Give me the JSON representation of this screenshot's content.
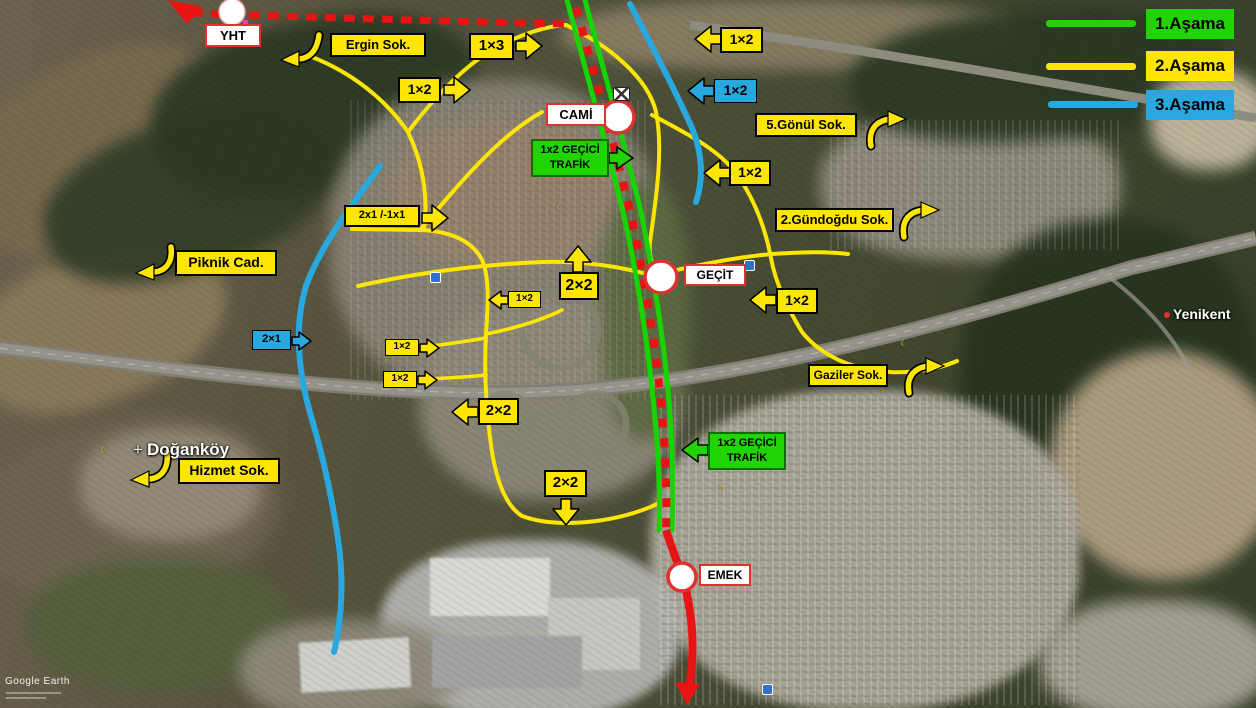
{
  "legend": {
    "items": [
      {
        "label": "1.Aşama",
        "color": "#1fd400"
      },
      {
        "label": "2.Aşama",
        "color": "#ffe600"
      },
      {
        "label": "3.Aşama",
        "color": "#29a8e0"
      }
    ]
  },
  "stations": [
    {
      "label": "YHT"
    },
    {
      "label": "CAMİ"
    },
    {
      "label": "GEÇİT"
    },
    {
      "label": "EMEK"
    }
  ],
  "map_labels": [
    {
      "text": "Ergin Sok."
    },
    {
      "text": "1×3"
    },
    {
      "text": "1×2"
    },
    {
      "text": "1×2"
    },
    {
      "text": "1×2"
    },
    {
      "text": "5.Gönül Sok."
    },
    {
      "text": "1×2"
    },
    {
      "text": "2.Gündoğdu Sok."
    },
    {
      "text": "2x1 /-1x1"
    },
    {
      "text": "Piknik Cad."
    },
    {
      "text": "2×2"
    },
    {
      "text": "1×2"
    },
    {
      "text": "1×2"
    },
    {
      "text": "1×2"
    },
    {
      "text": "2×2"
    },
    {
      "text": "2×1"
    },
    {
      "text": "1×2"
    },
    {
      "text": "Gaziler Sok."
    },
    {
      "text": "1x2 GEÇİCİ TRAFİK"
    },
    {
      "text": "1x2 GEÇİCİ TRAFİK"
    },
    {
      "text": "2×2"
    },
    {
      "text": "Hizmet Sok."
    }
  ],
  "place_names": {
    "dogankoy": "Doğanköy",
    "yenikent": "Yenikent"
  },
  "watermark": "Google Earth",
  "colors": {
    "phase1_green": "#17d400",
    "phase2_yellow": "#ffe600",
    "phase3_blue": "#29a8e0",
    "rail_red": "#e81313"
  }
}
